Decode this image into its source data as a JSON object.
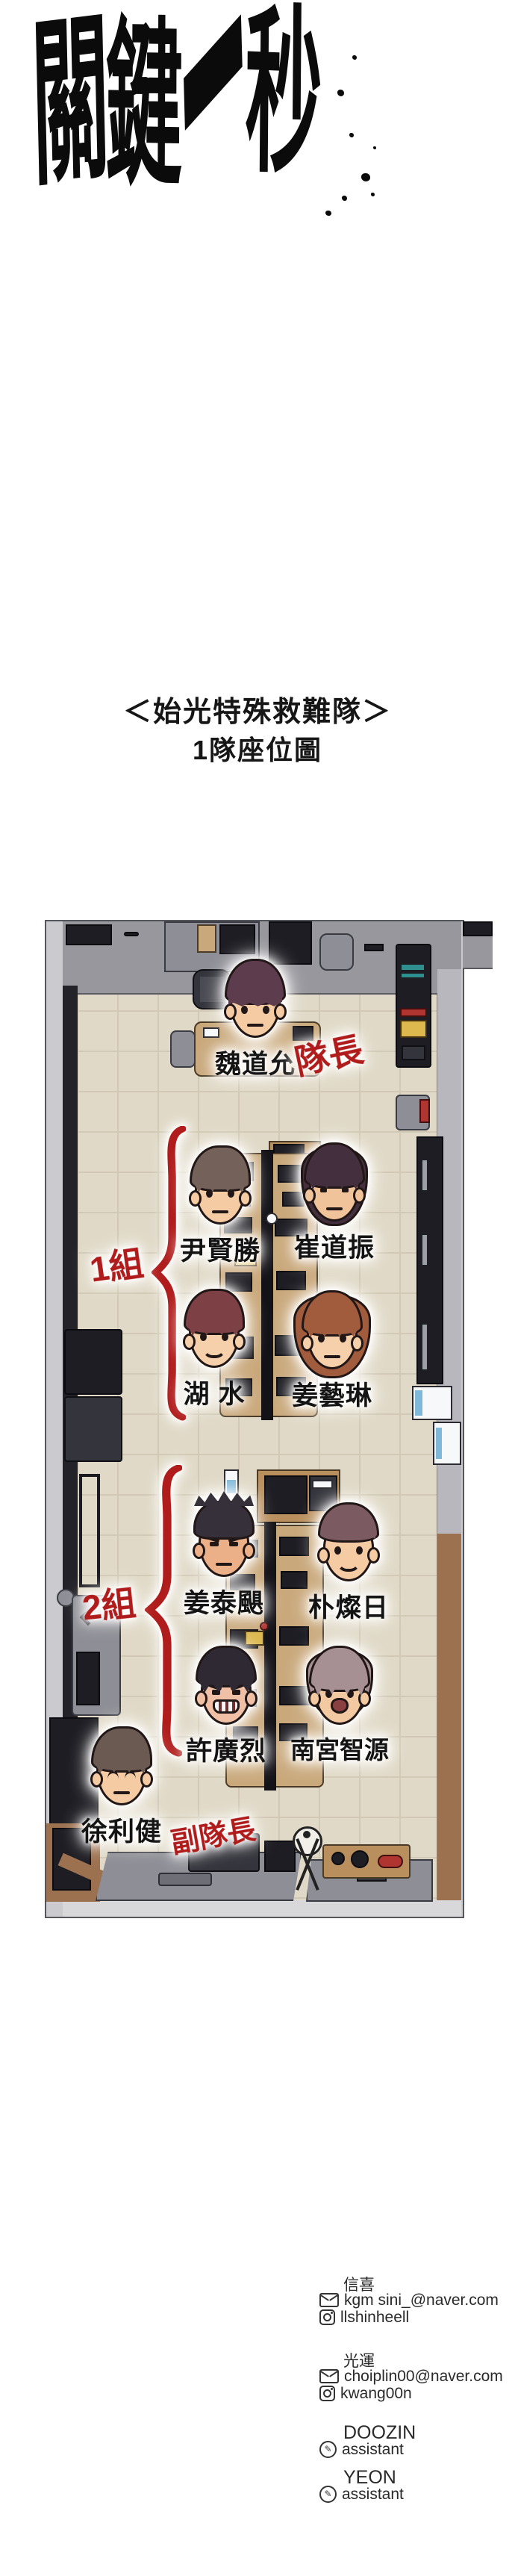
{
  "title": {
    "text": "關鍵一秒",
    "chars": [
      "關",
      "鍵",
      "一",
      "秒"
    ]
  },
  "subtitle": {
    "line1": "＜始光特殊救難隊＞",
    "line2": "1隊座位圖"
  },
  "map": {
    "annotation_color": "#b01c1c",
    "captain": {
      "name": "魏道允",
      "role": "隊長",
      "hair": "#5d3c4e",
      "skin": "#f5cba4",
      "style": "bowl",
      "mood": "neutral"
    },
    "vice_captain": {
      "name": "徐利健",
      "role": "副隊長",
      "hair": "#6b5a52",
      "skin": "#f5cba4",
      "style": "messy",
      "mood": "closed"
    },
    "groups": [
      {
        "label": "1組",
        "members": [
          {
            "name": "尹賢勝",
            "hair": "#74625a",
            "skin": "#f5cba4",
            "style": "messy",
            "mood": "neutral"
          },
          {
            "name": "崔道振",
            "hair": "#432f3d",
            "skin": "#f1c39b",
            "style": "long",
            "mood": "tired"
          },
          {
            "name": "湖 水",
            "hair": "#7c4045",
            "skin": "#f6d0ab",
            "style": "messy",
            "mood": "smile"
          },
          {
            "name": "姜藝琳",
            "hair": "#a15c3d",
            "skin": "#f6d0ab",
            "style": "longf",
            "mood": "neutral"
          }
        ]
      },
      {
        "label": "2組",
        "members": [
          {
            "name": "姜泰颶",
            "hair": "#353039",
            "skin": "#ecb088",
            "style": "spiky",
            "mood": "angry"
          },
          {
            "name": "朴燦日",
            "hair": "#7b5a61",
            "skin": "#f5cba4",
            "style": "short",
            "mood": "smile"
          },
          {
            "name": "許廣烈",
            "hair": "#2e2933",
            "skin": "#efc0a6",
            "style": "undercut",
            "mood": "grin"
          },
          {
            "name": "南宮智源",
            "hair": "#a69093",
            "skin": "#f3c9a1",
            "style": "fringe",
            "mood": "shout"
          }
        ]
      }
    ]
  },
  "credits": {
    "blocks": [
      {
        "header": "信喜",
        "lines": [
          {
            "icon": "email",
            "text": "kgm sini_@naver.com"
          },
          {
            "icon": "instagram",
            "text": "llshinheell"
          }
        ]
      },
      {
        "header": "光運",
        "lines": [
          {
            "icon": "email",
            "text": "choiplin00@naver.com"
          },
          {
            "icon": "instagram",
            "text": "kwang00n"
          }
        ]
      },
      {
        "header": "DOOZIN",
        "lines": [
          {
            "icon": "pencil",
            "text": "assistant"
          }
        ]
      },
      {
        "header": "YEON",
        "lines": [
          {
            "icon": "pencil",
            "text": "assistant"
          }
        ]
      }
    ]
  }
}
